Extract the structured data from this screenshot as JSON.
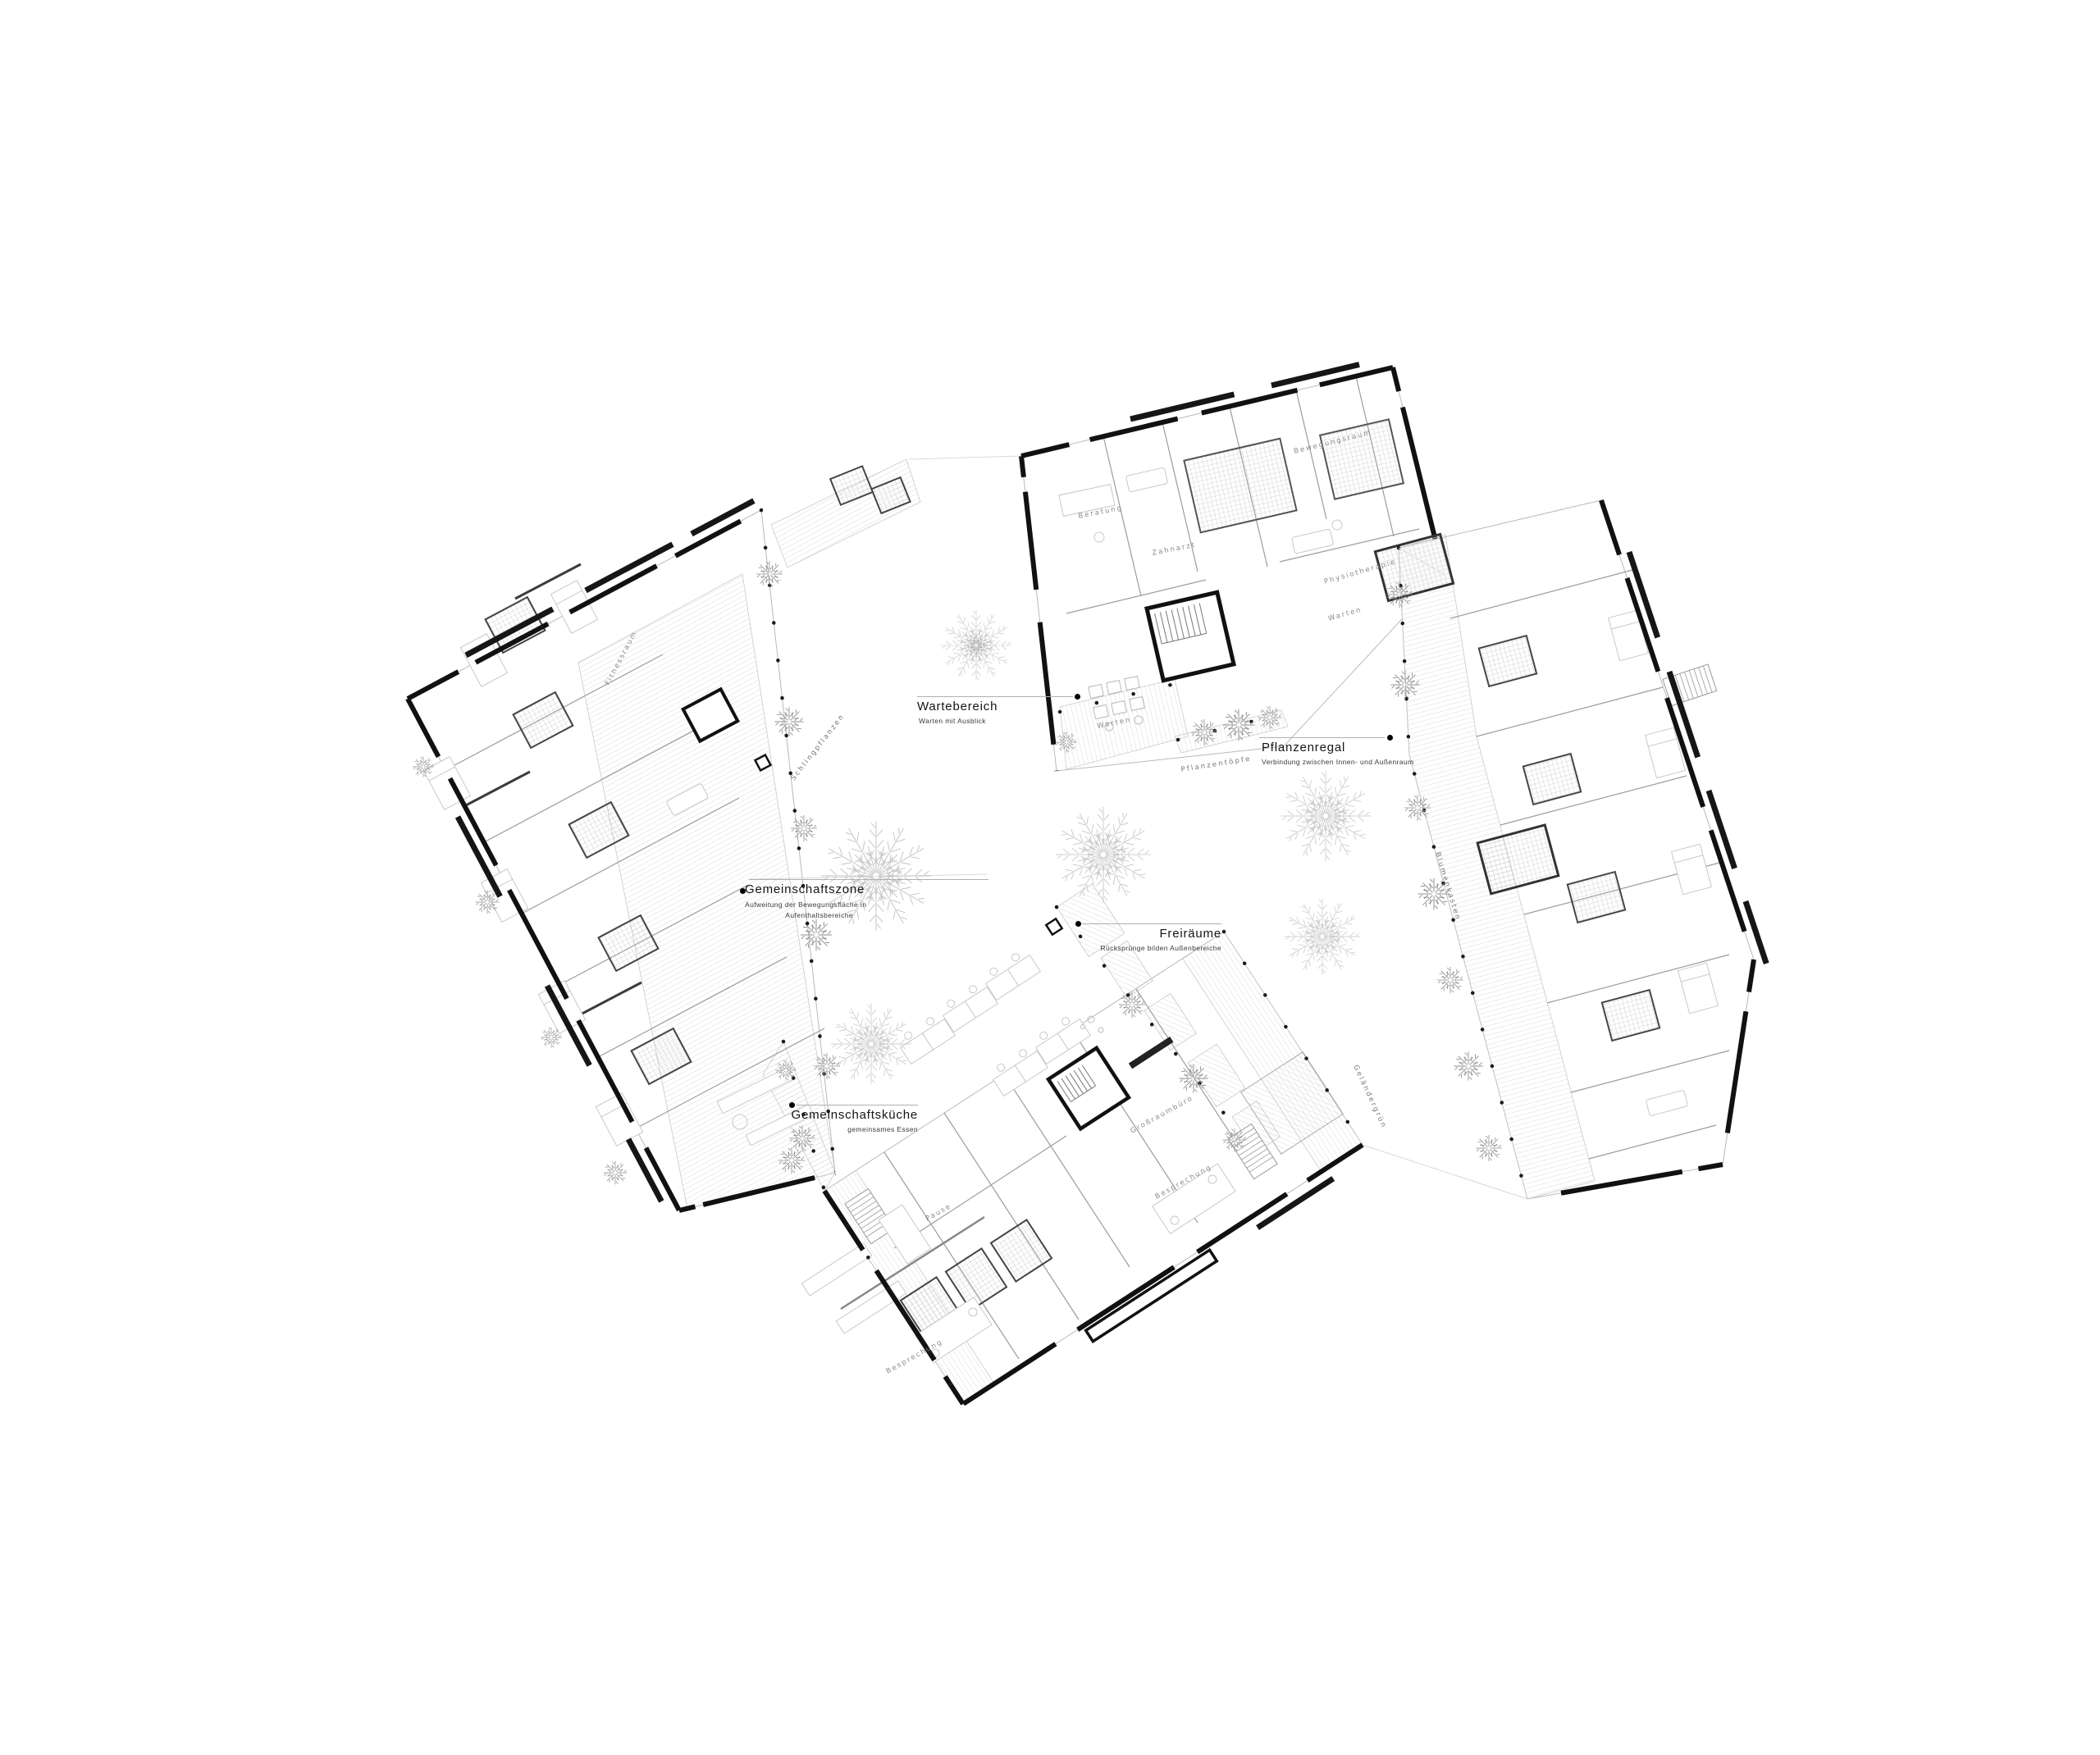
{
  "drawing": {
    "type": "architectural floor plan",
    "colors": {
      "ink": "#161616",
      "wall_dark": "#111111",
      "partition": "#9c9c9c",
      "outline": "#b9b9b9",
      "hatch": "#d6d6d6",
      "tree": "#c2c2c2",
      "shrub": "#8f8f8f",
      "label_gray": "#8a8a8a"
    }
  },
  "callouts": {
    "wartebereich": {
      "title": "Wartebereich",
      "subtitle": "Warten mit Ausblick"
    },
    "pflanzenregal": {
      "title": "Pflanzenregal",
      "subtitle": "Verbindung zwischen Innen- und Außenraum"
    },
    "gemeinschaftszone": {
      "title": "Gemeinschaftszone",
      "subtitle_line1": "Aufweitung der Bewegungsfläche in",
      "subtitle_line2": "Aufenthaltsbereiche"
    },
    "freiraeume": {
      "title": "Freiräume",
      "subtitle": "Rücksprünge bilden Außenbereiche"
    },
    "gemeinschaftskueche": {
      "title": "Gemeinschaftsküche",
      "subtitle": "gemeinsames Essen"
    }
  },
  "room_labels": {
    "fitnessraum": "Fitnessraum",
    "beratung": "Beratung",
    "zahnarzt": "Zahnarzt",
    "warten_dental": "Warten",
    "bewegungsraum": "Bewegungsraum",
    "physiotherapie": "Physiotherapie",
    "warten_physio": "Warten",
    "grossraumbuero": "Großraumbüro",
    "besprechung_1": "Besprechung",
    "besprechung_2": "Besprechung",
    "pause": "Pause"
  },
  "planting_labels": {
    "schlingpflanzen": "Schlingpflanzen",
    "pflanzentoepfe": "Pflanzentöpfe",
    "blumenkasten": "Blumenkasten",
    "gelaendergruen": "Geländergrün"
  }
}
